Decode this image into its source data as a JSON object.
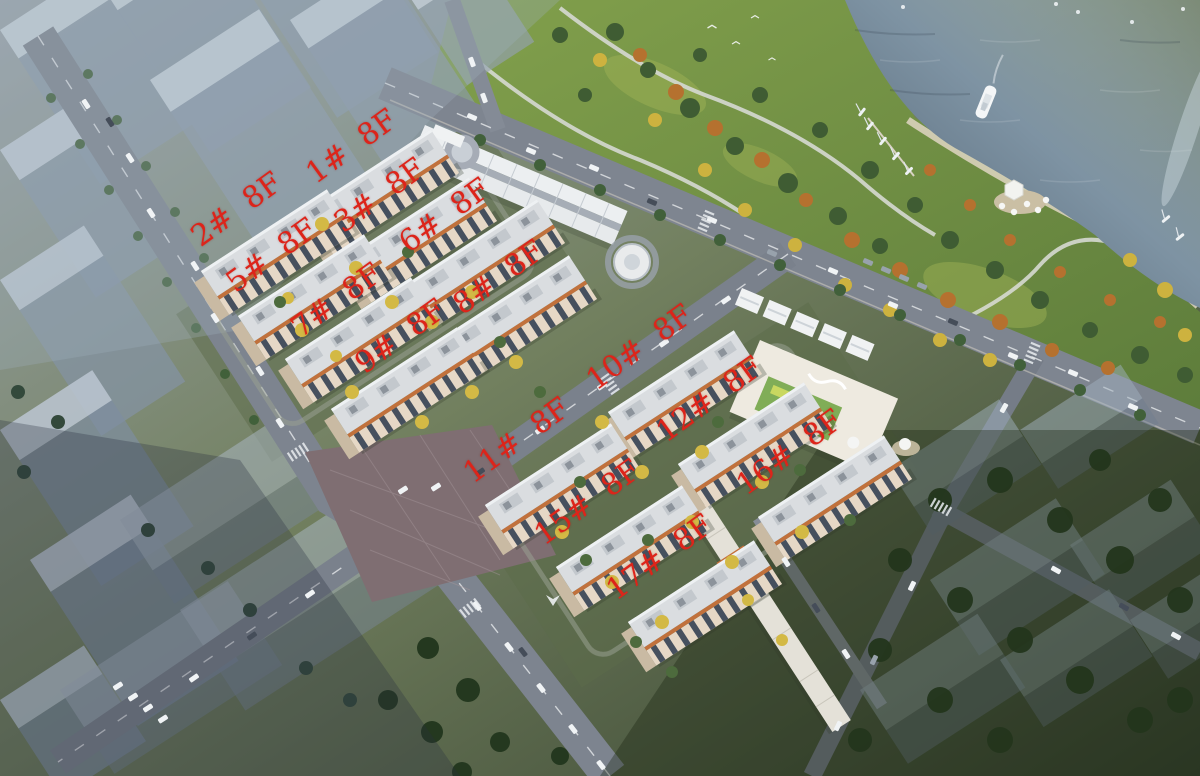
{
  "annotation": {
    "color": "#dd241a",
    "rotation_deg": -36,
    "labels": [
      {
        "id": "1",
        "building": "1#",
        "floors": "8F",
        "text": "1#  8F",
        "x": 352,
        "y": 147
      },
      {
        "id": "2",
        "building": "2#",
        "floors": "8F",
        "text": "2#  8F",
        "x": 237,
        "y": 210
      },
      {
        "id": "3",
        "building": "3#",
        "floors": "8F",
        "text": "3#  8F",
        "x": 380,
        "y": 196
      },
      {
        "id": "5",
        "building": "5#",
        "floors": "8F",
        "text": "5#  8F",
        "x": 272,
        "y": 256
      },
      {
        "id": "6",
        "building": "6#",
        "floors": "8F",
        "text": "6#  8F",
        "x": 445,
        "y": 216
      },
      {
        "id": "7",
        "building": "7#",
        "floors": "8F",
        "text": "7#  8F",
        "x": 337,
        "y": 301
      },
      {
        "id": "8",
        "building": "8#",
        "floors": "8F",
        "text": "8#  8F",
        "x": 499,
        "y": 278
      },
      {
        "id": "9",
        "building": "9#",
        "floors": "8F",
        "text": "9#  8F",
        "x": 401,
        "y": 337
      },
      {
        "id": "10",
        "building": "10#",
        "floors": "8F",
        "text": "10#  8F",
        "x": 640,
        "y": 348
      },
      {
        "id": "11",
        "building": "11#",
        "floors": "8F",
        "text": "11#  8F",
        "x": 517,
        "y": 441
      },
      {
        "id": "12",
        "building": "12#",
        "floors": "8F",
        "text": "12#  8F",
        "x": 710,
        "y": 400
      },
      {
        "id": "15",
        "building": "15#",
        "floors": "8F",
        "text": "15#  8F",
        "x": 588,
        "y": 503
      },
      {
        "id": "16",
        "building": "16#",
        "floors": "8F",
        "text": "16#  8F",
        "x": 790,
        "y": 453
      },
      {
        "id": "17",
        "building": "17#",
        "floors": "8F",
        "text": "17#  8F",
        "x": 660,
        "y": 558
      }
    ]
  },
  "scene": {
    "type": "aerial-architectural-render",
    "features": [
      "river-water",
      "waterfront-park",
      "yacht",
      "sailboat-marina",
      "park-paths",
      "residential-cluster-north",
      "residential-cluster-south",
      "commercial-strip",
      "kindergarten",
      "glass-massing-towers",
      "paved-plaza-intersection",
      "roads-with-cars"
    ],
    "colors": {
      "water_near": "#4f6071",
      "water_far": "#a9bac6",
      "park_green": "#6f8f43",
      "road_grey": "#7e8590",
      "plaza_mauve": "#7f6e72",
      "building_cream": "#e6d8c6",
      "building_trim_orange": "#c1713c",
      "glass_tower": "#8b9aab",
      "label_red": "#dd241a"
    }
  }
}
